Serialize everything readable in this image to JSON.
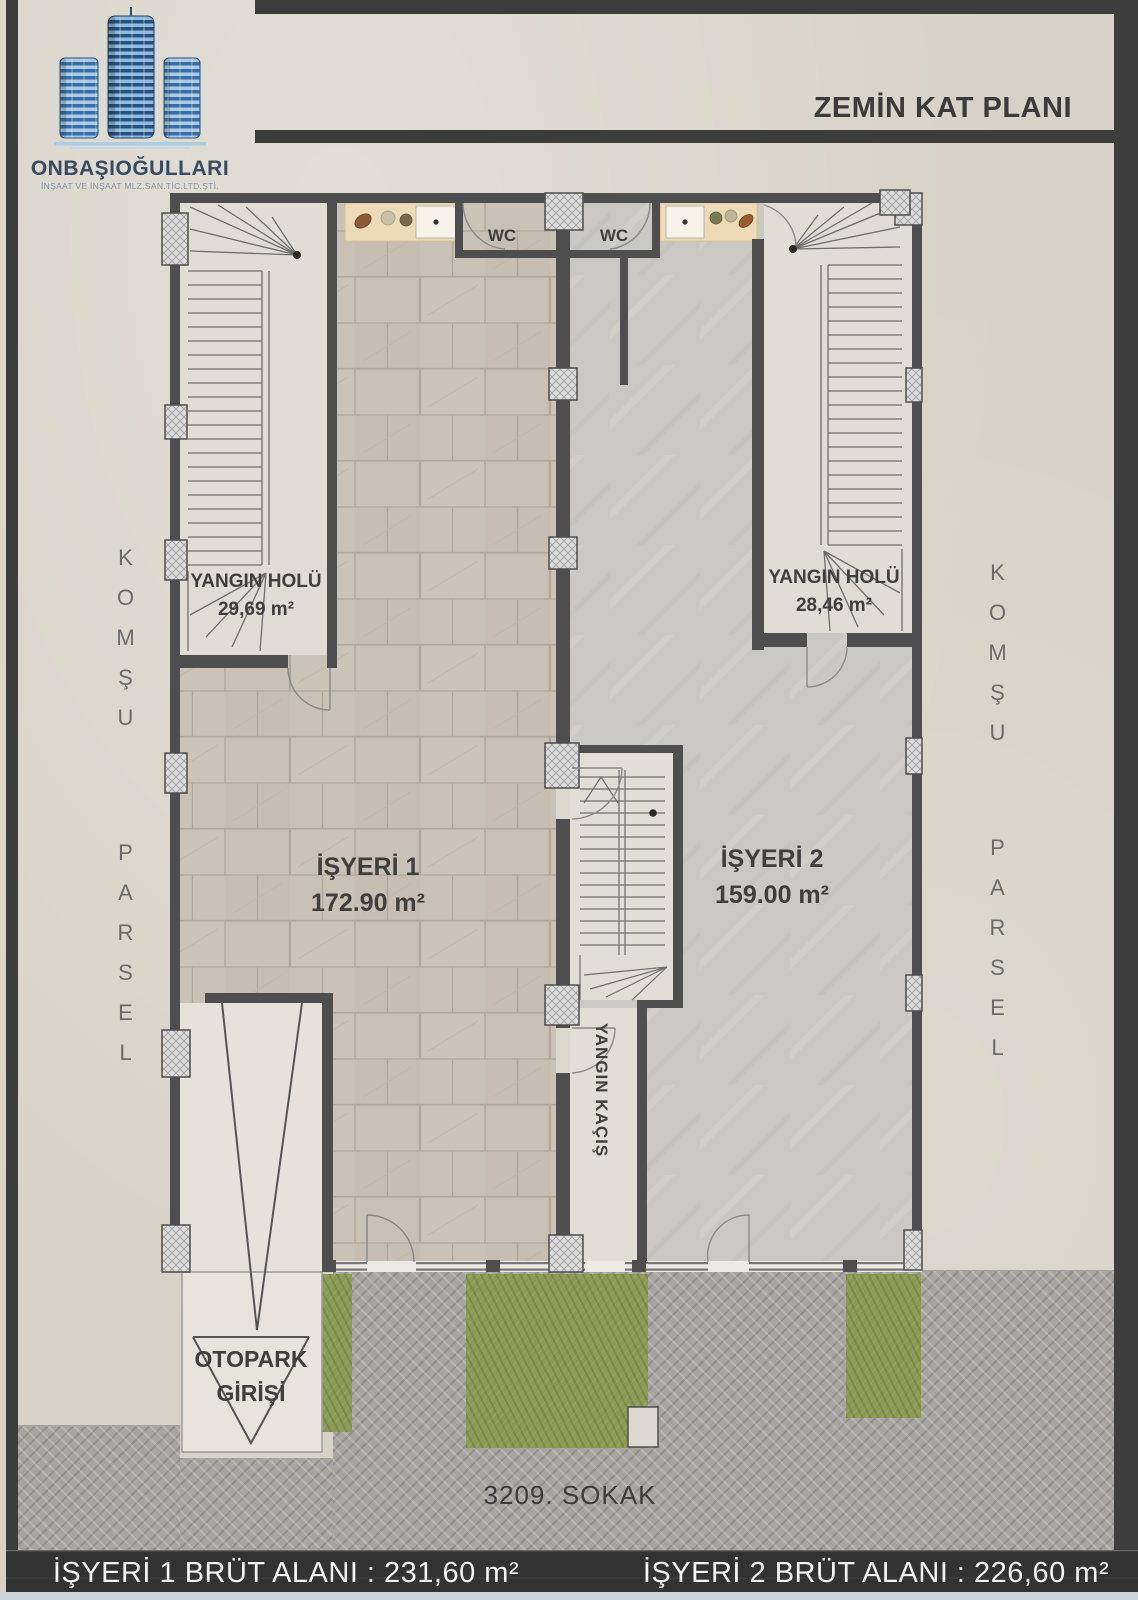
{
  "header": {
    "title": "ZEMİN KAT PLANI",
    "logo": {
      "company": "ONBAŞIOĞULLARI",
      "tagline": "İNŞAAT VE İNŞAAT MLZ.SAN.TİC.LTD.ŞTİ."
    }
  },
  "plan": {
    "rooms": [
      {
        "id": "yangin-holu-left",
        "label": "YANGIN HOLÜ",
        "area": "29,69 m²"
      },
      {
        "id": "yangin-holu-right",
        "label": "YANGIN HOLÜ",
        "area": "28,46 m²"
      },
      {
        "id": "isyeri-1",
        "label": "İŞYERİ 1",
        "area": "172.90 m²"
      },
      {
        "id": "isyeri-2",
        "label": "İŞYERİ 2",
        "area": "159.00 m²"
      }
    ],
    "wc_labels": [
      "WC",
      "WC"
    ],
    "fire_escape_label": "YANGIN KAÇIŞ",
    "parking_entrance": {
      "line1": "OTOPARK",
      "line2": "GİRİŞİ"
    },
    "street_name": "3209. SOKAK",
    "neighbor_left": {
      "top": "KOMŞU",
      "bottom": "PARSEL"
    },
    "neighbor_right": {
      "top": "KOMŞU",
      "bottom": "PARSEL"
    }
  },
  "footer": {
    "left_area": "İŞYERİ 1  BRÜT ALANI : 231,60 m²",
    "right_area": "İŞYERİ 2 BRÜT ALANI : 226,60 m²"
  },
  "colors": {
    "paper": "#d6d2c7",
    "frame": "#3d3d3d",
    "wall": "#4e4e4e",
    "tile_floor": "#c8c1b5",
    "marble_floor": "#c9c8c4",
    "counter": "#ecdbb6",
    "grass": "#8d9a54",
    "pavement": "#a6a5a2",
    "logo_blue_dark": "#27527f",
    "logo_blue_light": "#8fb9dd"
  }
}
